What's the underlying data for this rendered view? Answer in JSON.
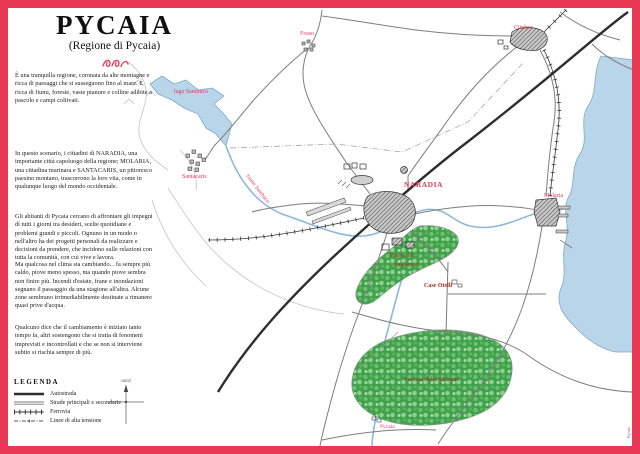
{
  "title": {
    "main": "PYCAIA",
    "subtitle": "(Regione di Pycaia)"
  },
  "intro_paragraphs": [
    "È una tranquilla regione, coronata da alte montagne e ricca di paesaggi che si susseguono fino al mare. È ricca di fiumi, foreste, vaste pianure e colline adibite a pascolo e campi coltivati.",
    "In questo scenario, i cittadini di NARADIA, una importante città capoluogo della regione; MOLARIA, una cittadina marinara e SANTACARIS, un pittoresco paesino montano, trascorrono la loro vita, come in qualunque luogo del mondo occidentale.",
    "Gli abitanti di Pycaia cercano di affrontare gli impegni di tutti i giorni tra desideri, scelte quotidiane e problemi grandi e piccoli. Ognuno in un modo o nell'altro ha dei progetti personali da realizzare e decisioni da prendere, che incidono sulle relazioni con tutta la comunità, con cui vive e lavora.",
    "Ma qualcosa nel clima sta cambiando... fa sempre più caldo, piove meno spesso, ma quando piove sembra non finire più. Incendi d'estate, frane e inondazioni segnano il passaggio da una stagione all'altra. Alcune zone sembrano irrimediabilmente destinate a rimanere quasi prive d'acqua.",
    "Qualcuno dice che il cambiamento è iniziato tanto tempo fa, altri sostengono che si tratta di fenomeni imprevisti e incontrollati e che se non si interviene subito si rischia sempre di più."
  ],
  "legend": {
    "heading": "LEGENDA",
    "items": [
      {
        "label": "Autostrada"
      },
      {
        "label": "Strade principali e secondarie"
      },
      {
        "label": "Ferrovia"
      },
      {
        "label": "Linee di alta tensione"
      }
    ]
  },
  "compass": {
    "label": "nord"
  },
  "map": {
    "labels": {
      "lake": "lago Sambuco",
      "river": "fiume Sambuco",
      "santacaris": "Santacaris",
      "fosso": "Fosso",
      "cimbro": "Cimbro",
      "naradia": "NARADIA",
      "molaria": "Molaria",
      "case_otelli": "Case Otelli",
      "pineta_line1": "Pineta del",
      "pineta_line2": "Sughereto",
      "foresta": "Foresta delle Murene",
      "pycaia_point": "Pycaia",
      "credit": "Pycaia"
    }
  },
  "colors": {
    "frame_red": "#e63853",
    "town_label_red": "#e23a5c",
    "forest_label_red": "#a33226",
    "water_blue": "#b8d5ea",
    "forest_green": "#3fa24a"
  }
}
